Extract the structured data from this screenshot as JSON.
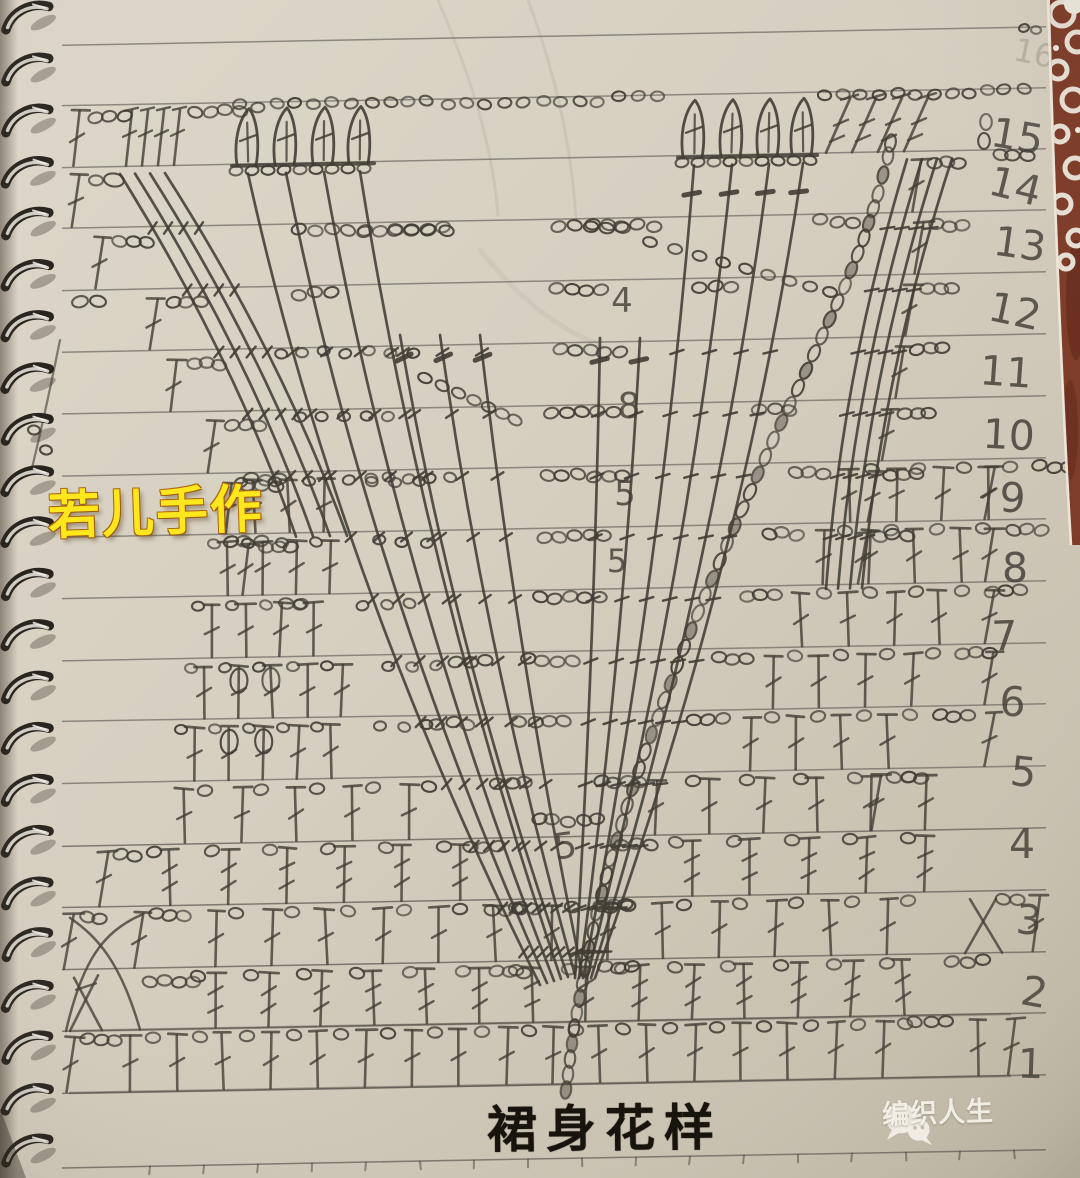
{
  "photo": {
    "watermark_text": "若儿手作",
    "title_text": "裙身花样",
    "brand": {
      "logo_text": "编织人生",
      "icon": "wechat-chat-bubbles-icon"
    },
    "row_numbers": [
      "15",
      "14",
      "13",
      "12",
      "11",
      "10",
      "9",
      "8",
      "7",
      "6",
      "5",
      "4",
      "3",
      "2",
      "1"
    ],
    "faint_row_number": "16",
    "pencil_digits": [
      "4",
      "8",
      "5",
      "5",
      "5"
    ],
    "colors": {
      "paper": "#d6cfc0",
      "paper_light": "#ddd7c9",
      "paper_dark": "#c2bba9",
      "pencil": "#413d35",
      "rule_line": "#6e6a62",
      "watermark_yellow": "#ffe71e",
      "watermark_outline": "#9c5b10",
      "title_ink": "#17140d",
      "logo_white": "#f3f0e8",
      "cloth_red": "#7c3a27",
      "cloth_red_dark": "#5d2517",
      "lace_white": "#ece8dc",
      "spiral_metal_light": "#cfccc4",
      "spiral_metal_dark": "#28251f"
    }
  }
}
